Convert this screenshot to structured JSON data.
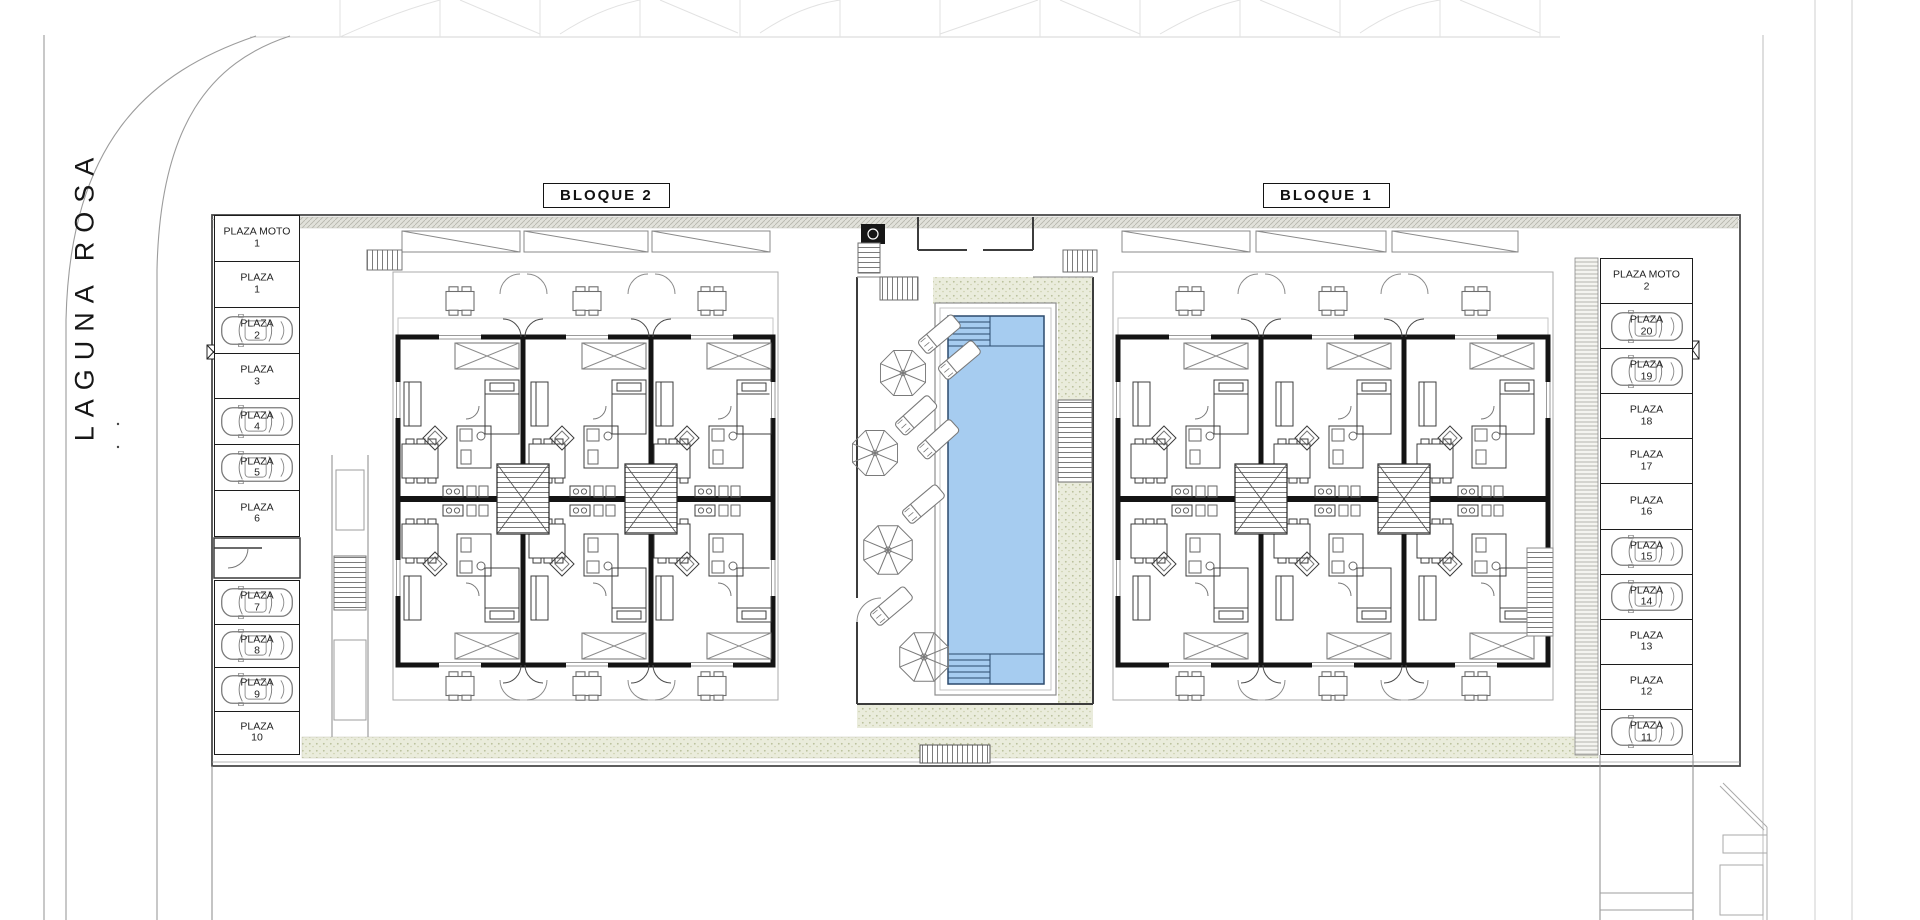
{
  "street": {
    "name": "LAGUNA ROSA"
  },
  "blocks": [
    {
      "label": "BLOQUE 2"
    },
    {
      "label": "BLOQUE 1"
    }
  ],
  "parking": {
    "left_top": [
      {
        "label": "PLAZA MOTO",
        "num": "1",
        "occupied": false
      },
      {
        "label": "PLAZA",
        "num": "1",
        "occupied": false
      },
      {
        "label": "PLAZA",
        "num": "2",
        "occupied": true
      },
      {
        "label": "PLAZA",
        "num": "3",
        "occupied": false
      },
      {
        "label": "PLAZA",
        "num": "4",
        "occupied": true
      },
      {
        "label": "PLAZA",
        "num": "5",
        "occupied": true
      },
      {
        "label": "PLAZA",
        "num": "6",
        "occupied": false
      }
    ],
    "left_bottom": [
      {
        "label": "PLAZA",
        "num": "7",
        "occupied": true
      },
      {
        "label": "PLAZA",
        "num": "8",
        "occupied": true
      },
      {
        "label": "PLAZA",
        "num": "9",
        "occupied": true
      },
      {
        "label": "PLAZA",
        "num": "10",
        "occupied": false
      }
    ],
    "right": [
      {
        "label": "PLAZA MOTO",
        "num": "2",
        "occupied": false
      },
      {
        "label": "PLAZA",
        "num": "20",
        "occupied": true
      },
      {
        "label": "PLAZA",
        "num": "19",
        "occupied": true
      },
      {
        "label": "PLAZA",
        "num": "18",
        "occupied": false
      },
      {
        "label": "PLAZA",
        "num": "17",
        "occupied": false
      },
      {
        "label": "PLAZA",
        "num": "16",
        "occupied": false
      },
      {
        "label": "PLAZA",
        "num": "15",
        "occupied": true
      },
      {
        "label": "PLAZA",
        "num": "14",
        "occupied": true
      },
      {
        "label": "PLAZA",
        "num": "13",
        "occupied": false
      },
      {
        "label": "PLAZA",
        "num": "12",
        "occupied": false
      },
      {
        "label": "PLAZA",
        "num": "11",
        "occupied": true
      }
    ]
  },
  "colors": {
    "pool_fill": "#a6ccf0",
    "pool_line": "#2b4a6d",
    "deck_fill": "#eaecdc",
    "wall": "#141414"
  }
}
